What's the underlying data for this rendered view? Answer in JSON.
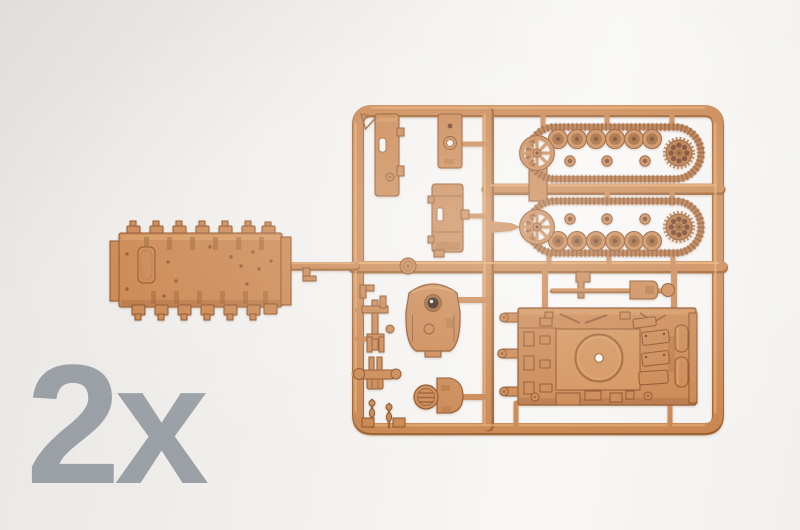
{
  "photo": {
    "quantity_label": "2x"
  },
  "colors": {
    "bg-a": "#e9e7e4",
    "bg-b": "#f2f0ed",
    "bg-c": "#f8f7f5",
    "plastic-main": "#c8824a",
    "plastic-raised": "#d18e55",
    "plastic-light": "#e6ab6e",
    "plastic-mid": "#b3703a",
    "plastic-dark": "#9a5c28",
    "plastic-outline": "#86491c",
    "plastic-deep": "#6e3318",
    "hole-white": "#f6f4f1",
    "label-gray": "#9aa0a5"
  }
}
